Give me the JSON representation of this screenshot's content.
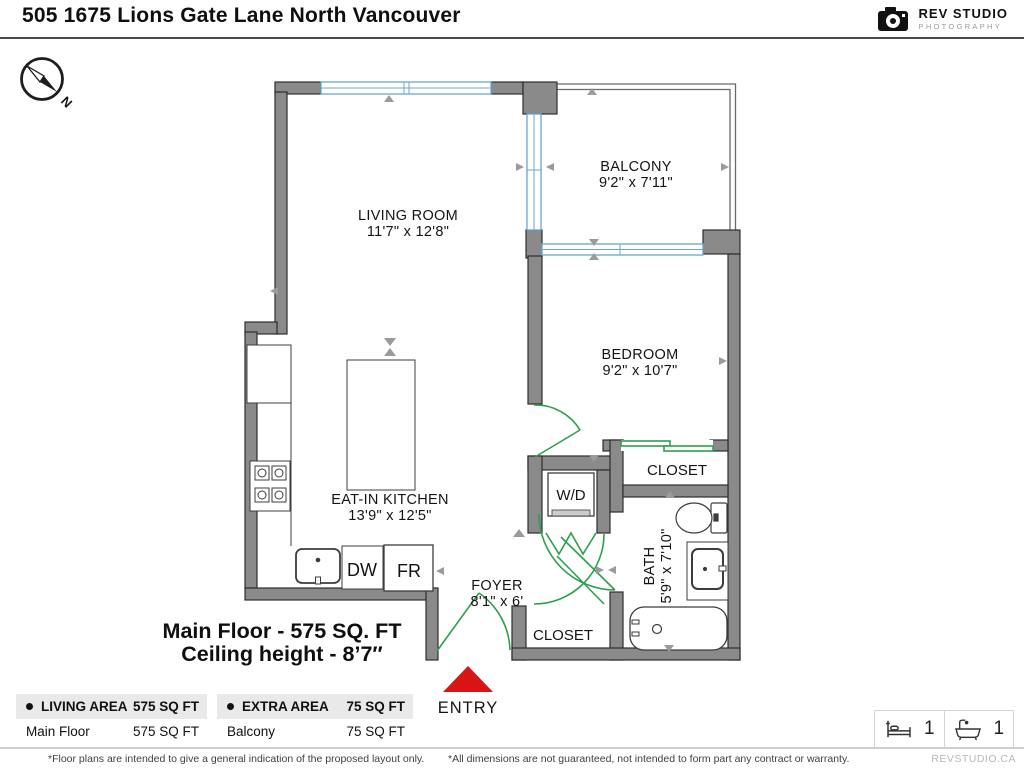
{
  "header": {
    "title": "505 1675 Lions Gate Lane North Vancouver",
    "logo_name": "REV STUDIO",
    "logo_sub": "PHOTOGRAPHY"
  },
  "compass": {
    "north_label": "N"
  },
  "floorplan": {
    "rooms": {
      "living": {
        "name": "LIVING ROOM",
        "dims": "11'7\" x 12'8\""
      },
      "balcony": {
        "name": "BALCONY",
        "dims": "9'2\" x 7'11\""
      },
      "bedroom": {
        "name": "BEDROOM",
        "dims": "9'2\" x 10'7\""
      },
      "kitchen": {
        "name": "EAT-IN KITCHEN",
        "dims": "13'9\" x 12'5\""
      },
      "foyer": {
        "name": "FOYER",
        "dims": "8'1\" x 6'"
      },
      "bath": {
        "name": "BATH",
        "dims": "5'9\" x 7'10\""
      }
    },
    "fixtures": {
      "wd": "W/D",
      "dw": "DW",
      "fr": "FR",
      "closet_bedroom": "CLOSET",
      "closet_entry": "CLOSET"
    },
    "summary": {
      "line1": "Main Floor - 575 SQ. FT",
      "line2": "Ceiling height - 8’7″"
    },
    "entry_label": "ENTRY"
  },
  "tables": [
    {
      "header": "LIVING AREA",
      "header_value": "575 SQ FT",
      "rows": [
        {
          "label": "Main Floor",
          "value": "575 SQ FT"
        }
      ]
    },
    {
      "header": "EXTRA AREA",
      "header_value": "75 SQ FT",
      "rows": [
        {
          "label": "Balcony",
          "value": "75 SQ FT"
        }
      ]
    }
  ],
  "counts": {
    "beds": "1",
    "baths": "1"
  },
  "footer": {
    "note_left": "*Floor plans are intended to give a general indication of the proposed layout only.",
    "note_right": "*All dimensions are not guaranteed, not intended to form part any contract or warranty.",
    "watermark": "REVSTUDIO.CA"
  },
  "colors": {
    "wall": "#8a8a8a",
    "window": "#6ca6cd",
    "door": "#2e9e50",
    "entry_arrow": "#d81414"
  }
}
